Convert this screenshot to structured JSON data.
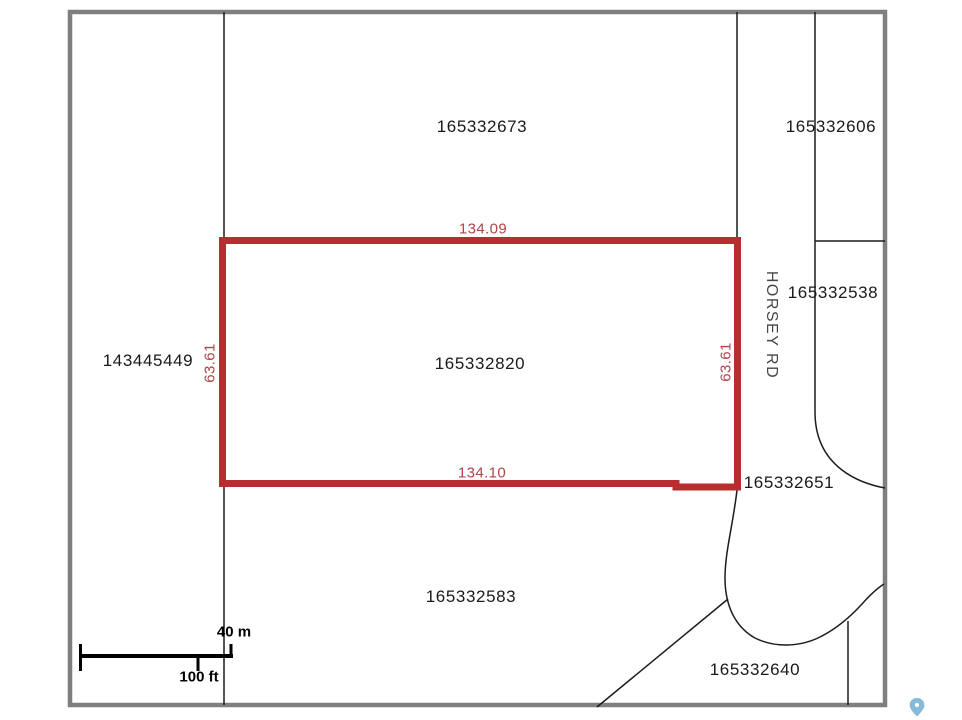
{
  "colors": {
    "border": "#7f7f7f",
    "line": "#1c1c1c",
    "label": "#1a1a1a",
    "highlight": "#b92c2f",
    "dim_text": "#b04348",
    "pin": "#85bad8"
  },
  "parcels": [
    {
      "id": "165332673"
    },
    {
      "id": "165332606"
    },
    {
      "id": "165332538"
    },
    {
      "id": "143445449"
    },
    {
      "id": "165332820"
    },
    {
      "id": "165332651"
    },
    {
      "id": "165332583"
    },
    {
      "id": "165332640"
    }
  ],
  "road": {
    "name": "HORSEY RD"
  },
  "highlighted_parcel": {
    "id": "165332820",
    "dimensions": {
      "top": "134.09",
      "bottom": "134.10",
      "left": "63.61",
      "right": "63.61"
    }
  },
  "scale_bar": {
    "metric": "40 m",
    "imperial": "100 ft"
  },
  "icons": {
    "pin": "location-pin"
  }
}
